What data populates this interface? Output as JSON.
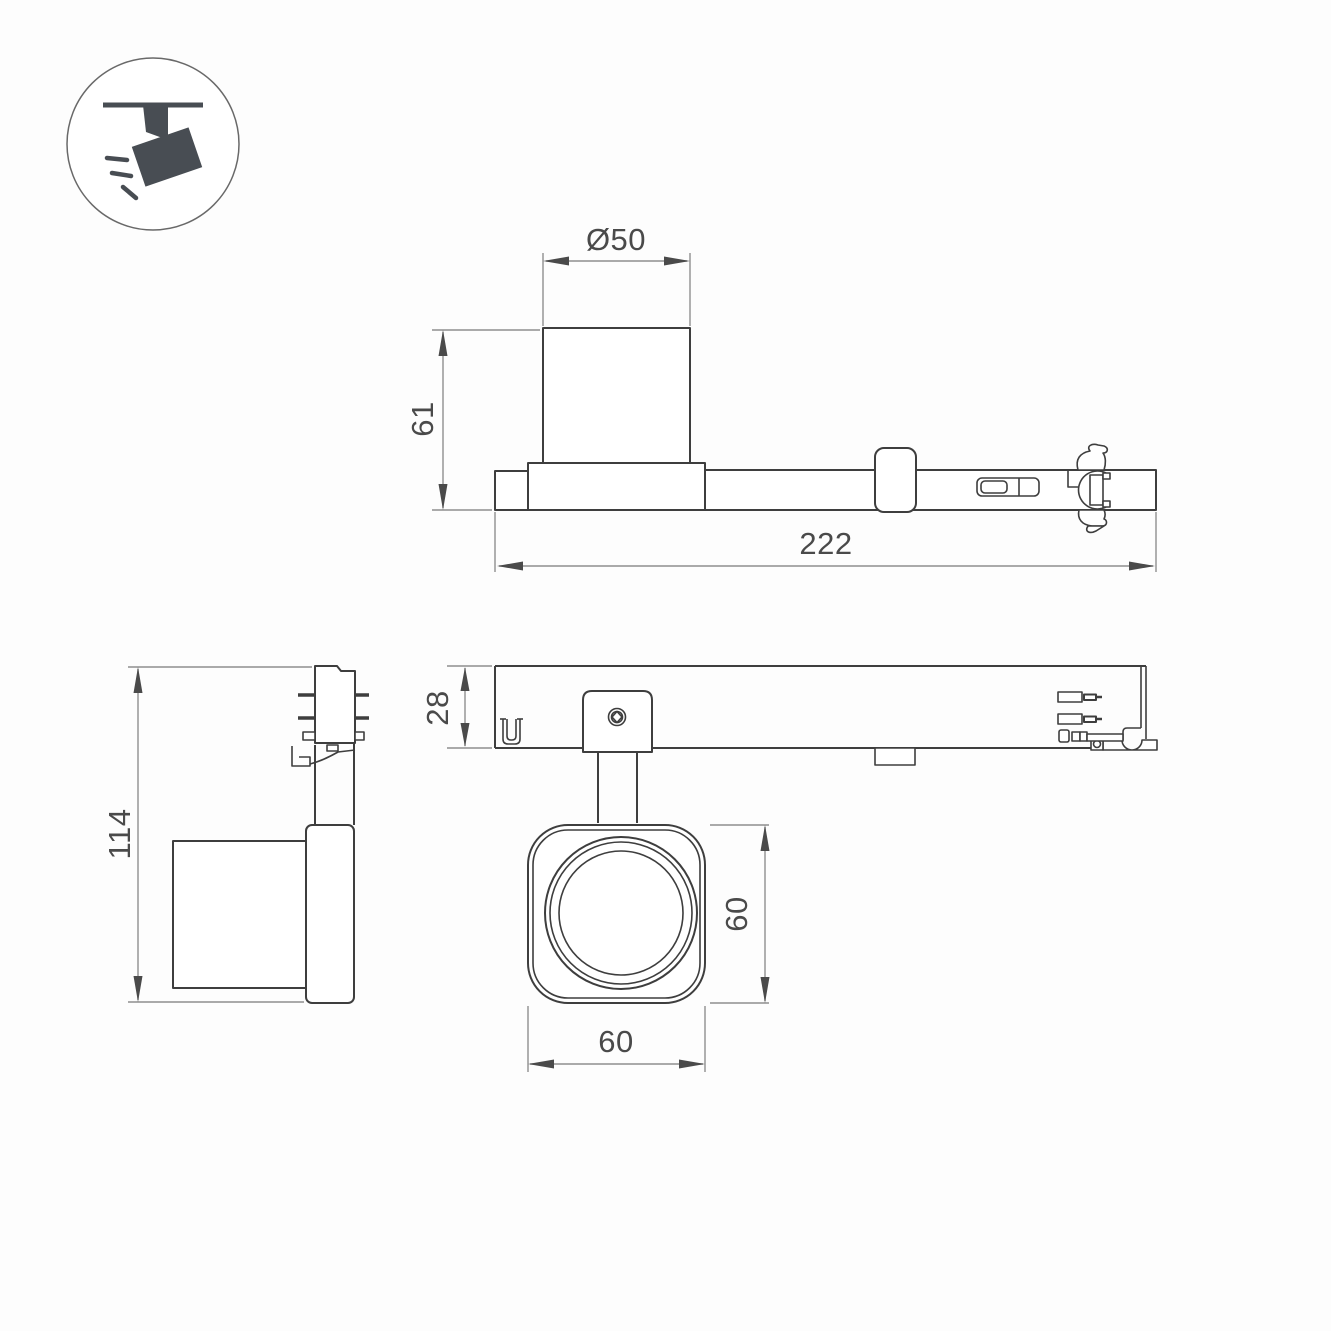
{
  "meta": {
    "background": "#fdfdfd"
  },
  "palette": {
    "object_line": "#3e3e3e",
    "dimension_line": "#8f8f8f",
    "arrow_fill": "#4a4a4a",
    "label_text": "#4a4a4a",
    "icon_fill": "#484d53",
    "icon_circle_stroke": "#696969"
  },
  "icon": {
    "name": "track-spotlight-icon"
  },
  "labels": {
    "top_view": {
      "diameter": "Ø50",
      "height": "61",
      "length": "222"
    },
    "side_view": {
      "overall_height": "114"
    },
    "track_view": {
      "profile_height": "28"
    },
    "head_view": {
      "height": "60",
      "width": "60"
    }
  }
}
